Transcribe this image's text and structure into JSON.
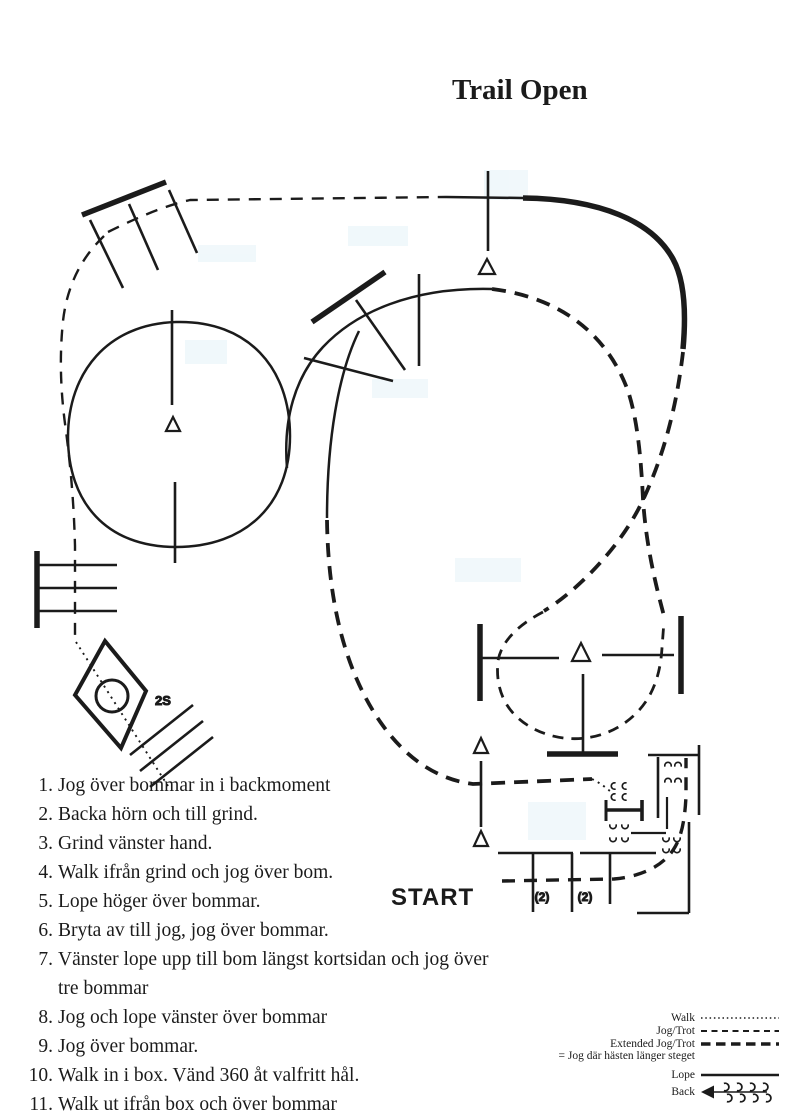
{
  "title": "Trail Open",
  "start_label": "START",
  "course": {
    "box_label": "2S",
    "pole_count_left": "(2)",
    "pole_count_right": "(2)"
  },
  "instructions": [
    {
      "num": "1.",
      "text": "Jog över bommar in i backmoment"
    },
    {
      "num": "2.",
      "text": "Backa hörn och till grind."
    },
    {
      "num": "3.",
      "text": "Grind vänster hand."
    },
    {
      "num": "4.",
      "text": "Walk ifrån grind och jog över bom."
    },
    {
      "num": "5.",
      "text": "Lope höger över bommar."
    },
    {
      "num": "6.",
      "text": "Bryta av till jog, jog över bommar."
    },
    {
      "num": "7.",
      "text": "Vänster lope upp till bom längst kortsidan och jog över",
      "text2": "tre bommar"
    },
    {
      "num": "8.",
      "text": "Jog och lope vänster över bommar"
    },
    {
      "num": "9.",
      "text": "Jog över bommar."
    },
    {
      "num": "10.",
      "text": "Walk in i box. Vänd 360 åt valfritt hål."
    },
    {
      "num": "11.",
      "text": "Walk ut ifrån box och över bommar"
    }
  ],
  "legend": {
    "walk": "Walk",
    "jog_trot": "Jog/Trot",
    "extended_jog_trot": "Extended Jog/Trot",
    "note": "= Jog där hästen länger steget",
    "lope": "Lope",
    "back": "Back"
  },
  "colors": {
    "ink": "#1b1b1b",
    "background": "#ffffff",
    "scan_artifact": "#e3f2f8"
  }
}
